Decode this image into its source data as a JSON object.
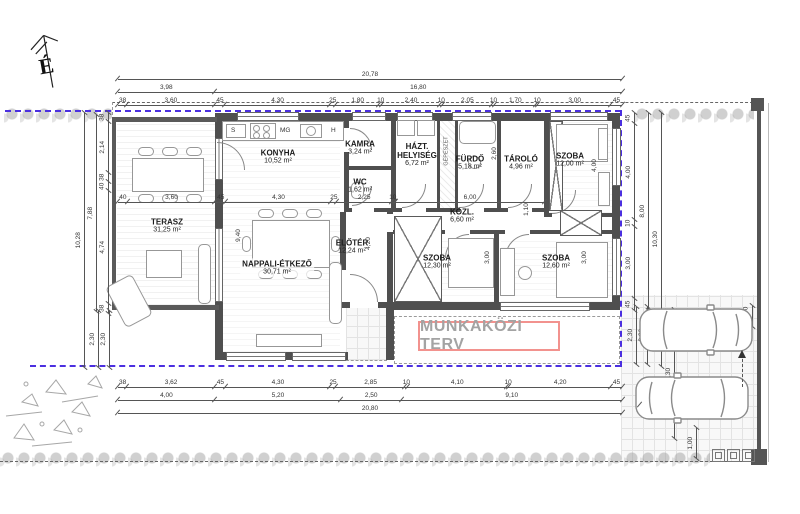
{
  "site": {
    "north_label": "É",
    "watermark": "MUNKAKÖZI TERV"
  },
  "rooms": {
    "terasz": {
      "name": "TERASZ",
      "area": "31,25 m²"
    },
    "konyha": {
      "name": "KONYHA",
      "area": "10,52 m²"
    },
    "kamra": {
      "name": "KAMRA",
      "area": "3,24 m²"
    },
    "wc": {
      "name": "WC",
      "area": "1,62 m²"
    },
    "hazt": {
      "name": "HÁZT. HELYISÉG",
      "area": "6,72 m²"
    },
    "furdo": {
      "name": "FÜRDŐ",
      "area": "5,18 m²"
    },
    "tarolo": {
      "name": "TÁROLÓ",
      "area": "4,96 m²"
    },
    "szoba_n": {
      "name": "SZOBA",
      "area": "12,00 m²"
    },
    "kozl": {
      "name": "KÖZL.",
      "area": "6,60 m²"
    },
    "eloter": {
      "name": "ELŐTÉR",
      "area": "12,24 m²"
    },
    "nappali": {
      "name": "NAPPALI-ÉTKEZŐ",
      "area": "30,71 m²"
    },
    "szoba_k": {
      "name": "SZOBA",
      "area": "12,30 m²"
    },
    "szoba_d": {
      "name": "SZOBA",
      "area": "12,60 m²"
    }
  },
  "kitchen": {
    "s": "S",
    "mg": "MG",
    "h": "H"
  },
  "annotations": {
    "gepeszet": "GÉPÉSZET"
  },
  "colors": {
    "wall": "#4f4f4f",
    "boundary": "#4b2fe0",
    "watermark_border": "#f2928e",
    "watermark_text": "#a3a3a3"
  },
  "dims": {
    "top_total": [
      "20,78"
    ],
    "top_row2": [
      "3,98",
      "16,80"
    ],
    "top_chain": [
      "38",
      "3,60",
      "45",
      "4,30",
      "25",
      "1,80",
      "10",
      "2,40",
      "10",
      "2,05",
      "10",
      "1,70",
      "10",
      "3,00",
      "45"
    ],
    "interior_chain": [
      "40",
      "3,60",
      "45",
      "4,30",
      "25",
      "2,25",
      "10"
    ],
    "kozl_chain": [
      "6,00"
    ],
    "bottom_chain": [
      "38",
      "3,62",
      "45",
      "4,30",
      "25",
      "2,85",
      "10",
      "4,10",
      "10",
      "4,20",
      "45"
    ],
    "bottom_row2": [
      "4,00",
      "5,20",
      "2,50",
      "9,10"
    ],
    "bottom_total": [
      "20,80"
    ],
    "right_chain": [
      "45",
      "4,00",
      "10",
      "3,00",
      "45"
    ],
    "right_total_8": [
      "8,00"
    ],
    "right_total_10": [
      "10,30"
    ],
    "left_chain": [
      "38",
      "2,14",
      "38",
      "40",
      "4,74",
      "38"
    ],
    "left_total_7": [
      "7,88"
    ],
    "left_total_10": [
      "10,28"
    ],
    "park": {
      "a": [
        "2,30"
      ],
      "b": [
        "2,30"
      ],
      "c": [
        "2,30"
      ],
      "d": [
        "2,30"
      ]
    },
    "car_length": [
      "5,30"
    ],
    "car_length2": [
      "5,25"
    ],
    "walk": [
      "1,00"
    ],
    "fence_w": [
      "40"
    ],
    "interior": {
      "i940": "9,40",
      "i420": "4,20",
      "i110": "1,10",
      "i260": "2,60",
      "i300a": "3,00",
      "i300b": "3,00",
      "i400": "4,00"
    }
  }
}
